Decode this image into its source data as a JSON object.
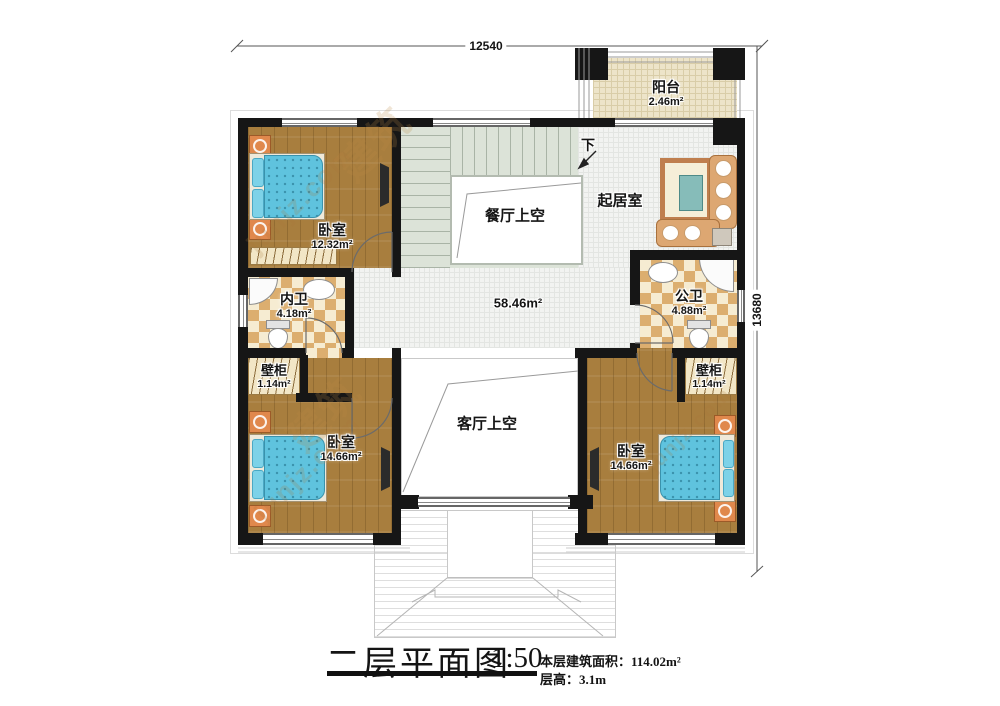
{
  "dimensions": {
    "width": "12540",
    "height": "13680"
  },
  "rooms": {
    "balcony": {
      "name": "阳台",
      "area": "2.46m²"
    },
    "bedroom1": {
      "name": "卧室",
      "area": "12.32m²"
    },
    "inner_bath": {
      "name": "内卫",
      "area": "4.18m²"
    },
    "public_bath": {
      "name": "公卫",
      "area": "4.88m²"
    },
    "closet_left": {
      "name": "壁柜",
      "area": "1.14m²"
    },
    "closet_right": {
      "name": "壁柜",
      "area": "1.14m²"
    },
    "bedroom2": {
      "name": "卧室",
      "area": "14.66m²"
    },
    "bedroom3": {
      "name": "卧室",
      "area": "14.66m²"
    },
    "living_room": {
      "name": "起居室"
    },
    "dining_void": {
      "name": "餐厅上空"
    },
    "living_void": {
      "name": "客厅上空"
    },
    "hall": {
      "area": "58.46m²"
    },
    "stair": {
      "down": "下"
    }
  },
  "title_block": {
    "title": "二层平面图",
    "scale": "1:50",
    "floor_area_label": "本层建筑面积：",
    "floor_area_value": "114.02m²",
    "floor_height_label": "层高：",
    "floor_height_value": "3.1m"
  },
  "watermark": {
    "text": "junjz.com",
    "logo": "建筑"
  },
  "colors": {
    "wall": "#161616",
    "wood": "#a87e3e",
    "tile": "#f2f3f1",
    "tileline": "#e3e5e2",
    "checkdark": "#dcae6f",
    "checklight": "#f6ecd2",
    "stairs": "#dce3d8",
    "stairline": "#a9b4a6",
    "balcony": "#ede4c9",
    "balcline": "#d9cda8",
    "bed": "#5fc3de",
    "beddot": "#3a92ac",
    "pillow": "#7dd2e8",
    "sofa": "#dda772",
    "rug": "#f5eed8",
    "rugborder": "#bf7e4e",
    "ctable": "#86bcb9",
    "nstand": "#e0884c"
  }
}
